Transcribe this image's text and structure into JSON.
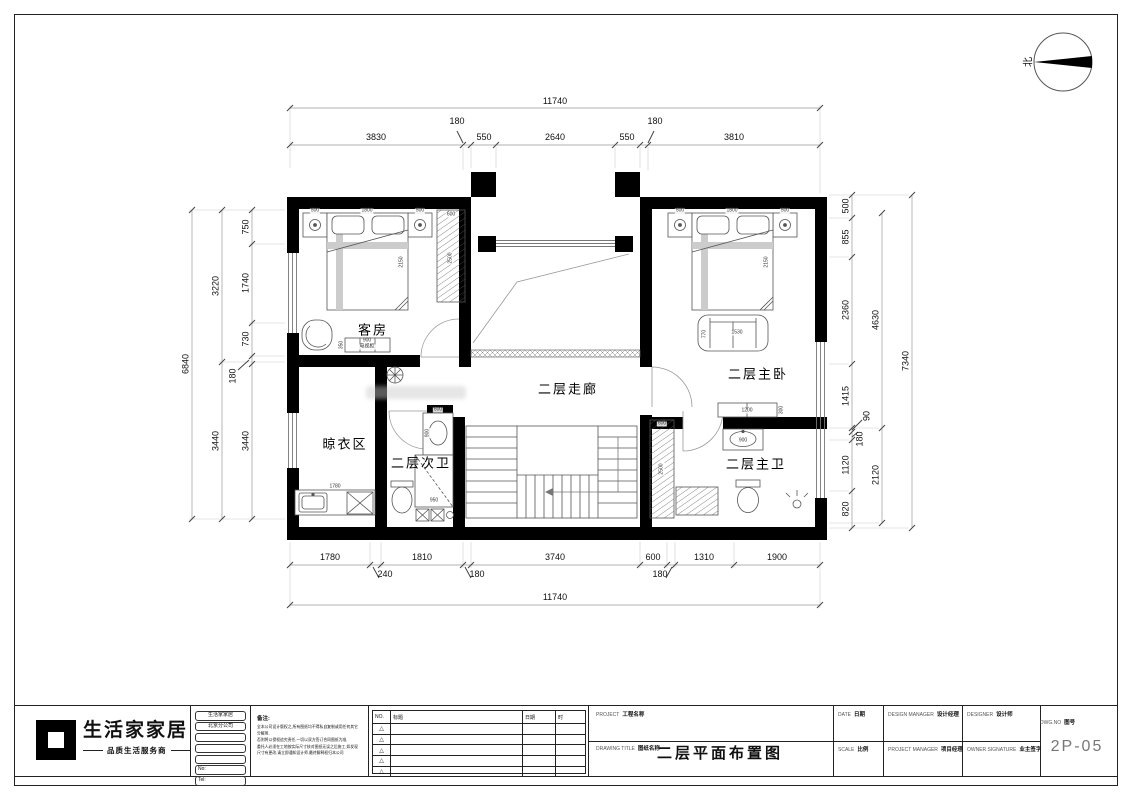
{
  "north": {
    "label": "北"
  },
  "plan": {
    "rooms": {
      "guest": "客房",
      "corridor": "二层走廊",
      "master": "二层主卧",
      "drying": "晾衣区",
      "bath2": "二层次卫",
      "bath1": "二层主卫"
    },
    "labels": {
      "nightstand": "500",
      "bed_w": "1800",
      "bed_l": "2150",
      "wardrobe_w": "600",
      "wardrobe_h": "2500",
      "tv_w": "900",
      "tv_name": "电视柜",
      "tv_d": "350",
      "sofa_l": "1530",
      "sofa_d": "770",
      "dresser_w": "1200",
      "dresser_d": "300",
      "basin1_w": "900",
      "basin2_w": "600",
      "basin2_d": "900",
      "shower": "950",
      "counter": "1780"
    }
  },
  "dims": {
    "top_total": "11740",
    "top": [
      "3830",
      "180",
      "550",
      "2640",
      "550",
      "180",
      "3810"
    ],
    "bottom": [
      "1780",
      "240",
      "1810",
      "180",
      "3740",
      "600",
      "180",
      "1310",
      "1900"
    ],
    "bottom_total": "11740",
    "left_outer": "6840",
    "left_mid": [
      "3220",
      "3440"
    ],
    "left_inner": [
      "750",
      "1740",
      "730",
      "180",
      "3440"
    ],
    "right_inner": [
      "500",
      "855",
      "2360",
      "1415",
      "90",
      "180",
      "1120",
      "820"
    ],
    "right_mid": [
      "4630",
      "2120"
    ],
    "right_outer": "7340"
  },
  "title_block": {
    "logo_text": "生活家家居",
    "logo_tagline": "品质生活服务商",
    "company_boxes": [
      "生活家家居",
      "北京分公司",
      "",
      "",
      "",
      "No:",
      "Tel:"
    ],
    "note_title": "备注:",
    "note_lines": [
      "全本公司设计版权之,所有图纸均不得私自复制或用任何其它分解用,",
      "否则将以侵权追究责任,一切以双方签订合同图纸为准,",
      "委托人必须在工地按实际尺寸核对图纸无误之后施工,如发现",
      "尺寸有更改,请立即通知设计师,最终解释权归本公司"
    ],
    "revision": {
      "headers": [
        "NO.",
        "标题",
        "日期",
        "时"
      ],
      "mark": "△"
    },
    "project_label": "PROJECT",
    "project_label_cn": "工程名称",
    "drawing_label": "DRAWING TITLE",
    "drawing_label_cn": "图纸名称",
    "drawing_title": "二层平面布置图",
    "fields": [
      {
        "en": "DATE",
        "cn": "日期"
      },
      {
        "en": "DESIGN MANAGER",
        "cn": "设计经理"
      },
      {
        "en": "DESIGNER",
        "cn": "设计师"
      },
      {
        "en": "SCALE",
        "cn": "比例"
      },
      {
        "en": "PROJECT MANAGER",
        "cn": "项目经理"
      },
      {
        "en": "OWNER SIGNATURE",
        "cn": "业主签字"
      }
    ],
    "dwg_label": "DWG.NO",
    "dwg_label_cn": "图号",
    "dwg_no": "2P-05"
  }
}
